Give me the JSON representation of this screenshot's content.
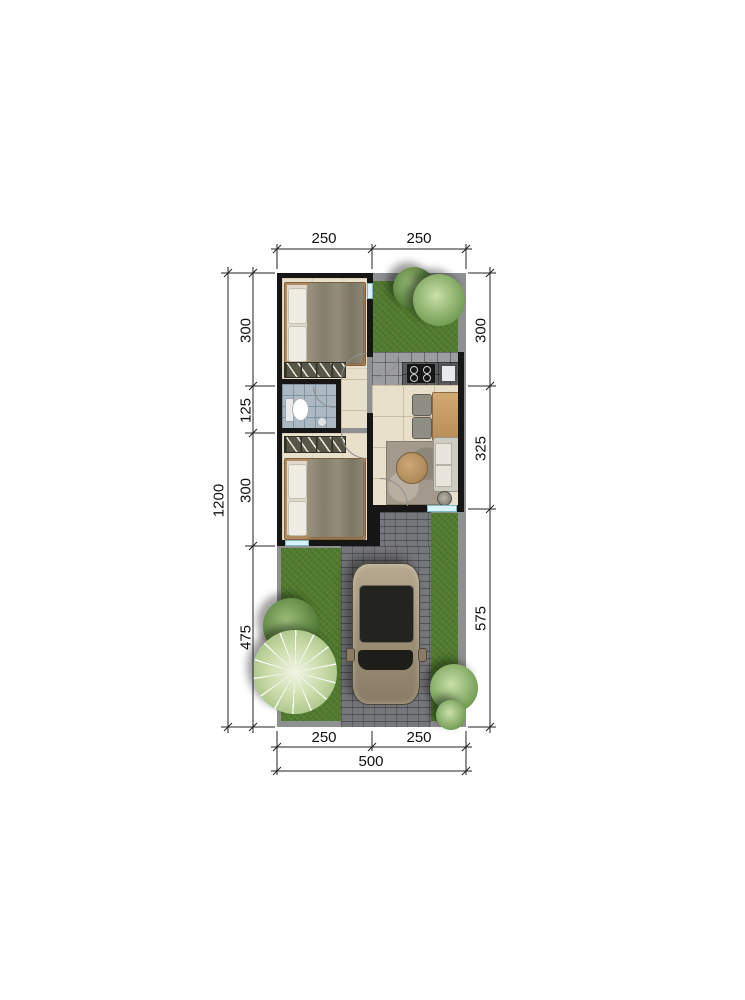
{
  "drawing": {
    "type": "residential-floor-plan-site-plan"
  },
  "dims": {
    "top": [
      "250",
      "250"
    ],
    "bottom": [
      "250",
      "250"
    ],
    "bottom_total": "500",
    "left_total": "1200",
    "left": [
      "300",
      "125",
      "300",
      "475"
    ],
    "right": [
      "300",
      "325",
      "575"
    ]
  },
  "colors": {
    "wall": "#161616",
    "floor_beige": "#e9e0cb",
    "bath_tile": "#adb9c2",
    "grass": "#527c2f",
    "pavement": "#76777a",
    "plot_border": "#8f9092",
    "path_tile": "#9c9d9f",
    "counter": "#5a5c5e",
    "bed_frame": "#b08b5e",
    "pillow": "#efece4",
    "wardrobe": "#565747",
    "rug": "#a39a8d",
    "window": "#bfe9f2",
    "dim_line": "#222222"
  }
}
